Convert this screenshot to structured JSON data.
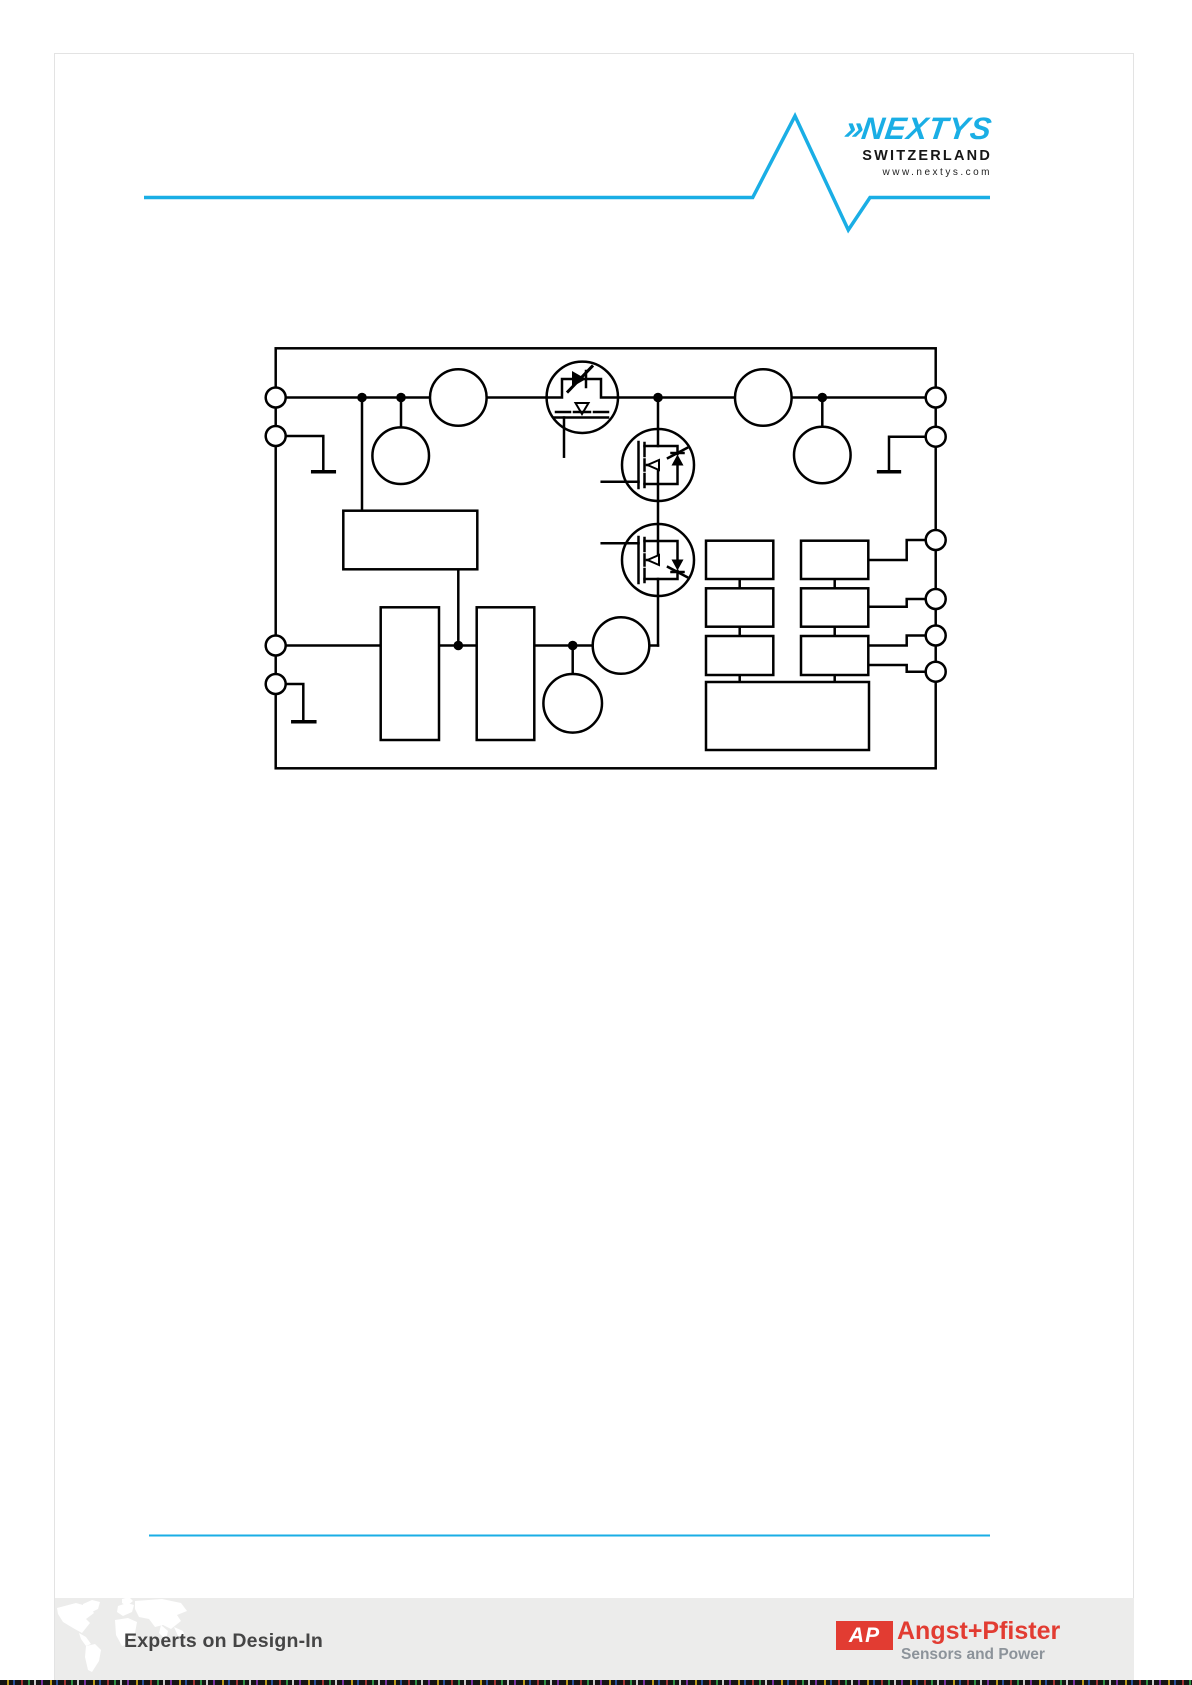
{
  "header": {
    "rule_color": "#1aaee5",
    "logo": {
      "chevrons": "»",
      "name": "NEXTYS",
      "country": "SWITZERLAND",
      "website": "www.nextys.com",
      "brand_color": "#1aaee5"
    }
  },
  "diagram": {
    "line_color": "#000000",
    "ports_left": 4,
    "ports_right": 6,
    "transistor_symbols": 3,
    "circle_components": 6,
    "rectangular_blocks": 10
  },
  "footer": {
    "rule_color": "#1aaee5",
    "band_color": "#ececeb",
    "tagline": "Experts on Design-In",
    "partner_monogram": "AP",
    "partner_name": "Angst+Pfister",
    "partner_subtitle": "Sensors and Power",
    "partner_red": "#e23c32",
    "partner_gray": "#8c939a"
  }
}
